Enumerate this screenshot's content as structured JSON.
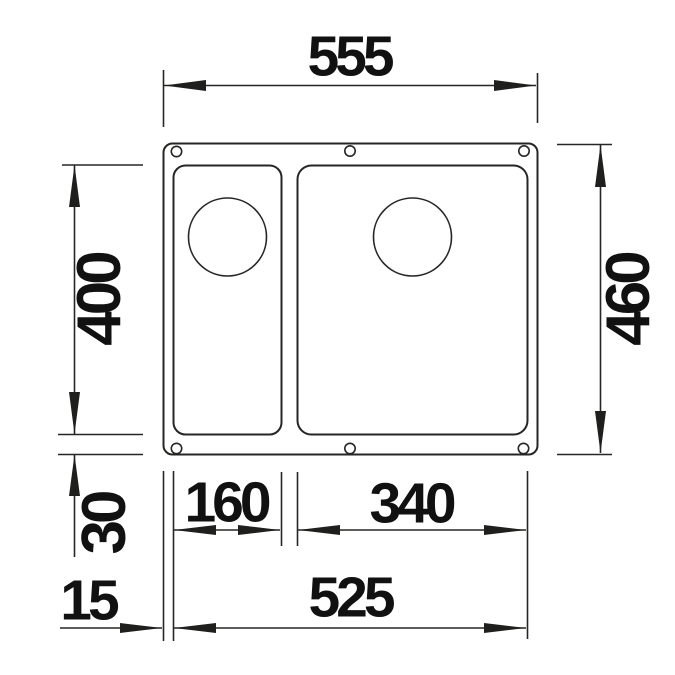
{
  "colors": {
    "background": "#ffffff",
    "line": "#262624",
    "text": "#111111"
  },
  "dims": {
    "overall_width": "555",
    "overall_depth": "460",
    "bowl_depth": "400",
    "rim_to_bowl_bottom": "30",
    "small_bowl_width": "160",
    "large_bowl_width": "340",
    "bowls_overall_width": "525",
    "left_rim_offset": "15"
  }
}
